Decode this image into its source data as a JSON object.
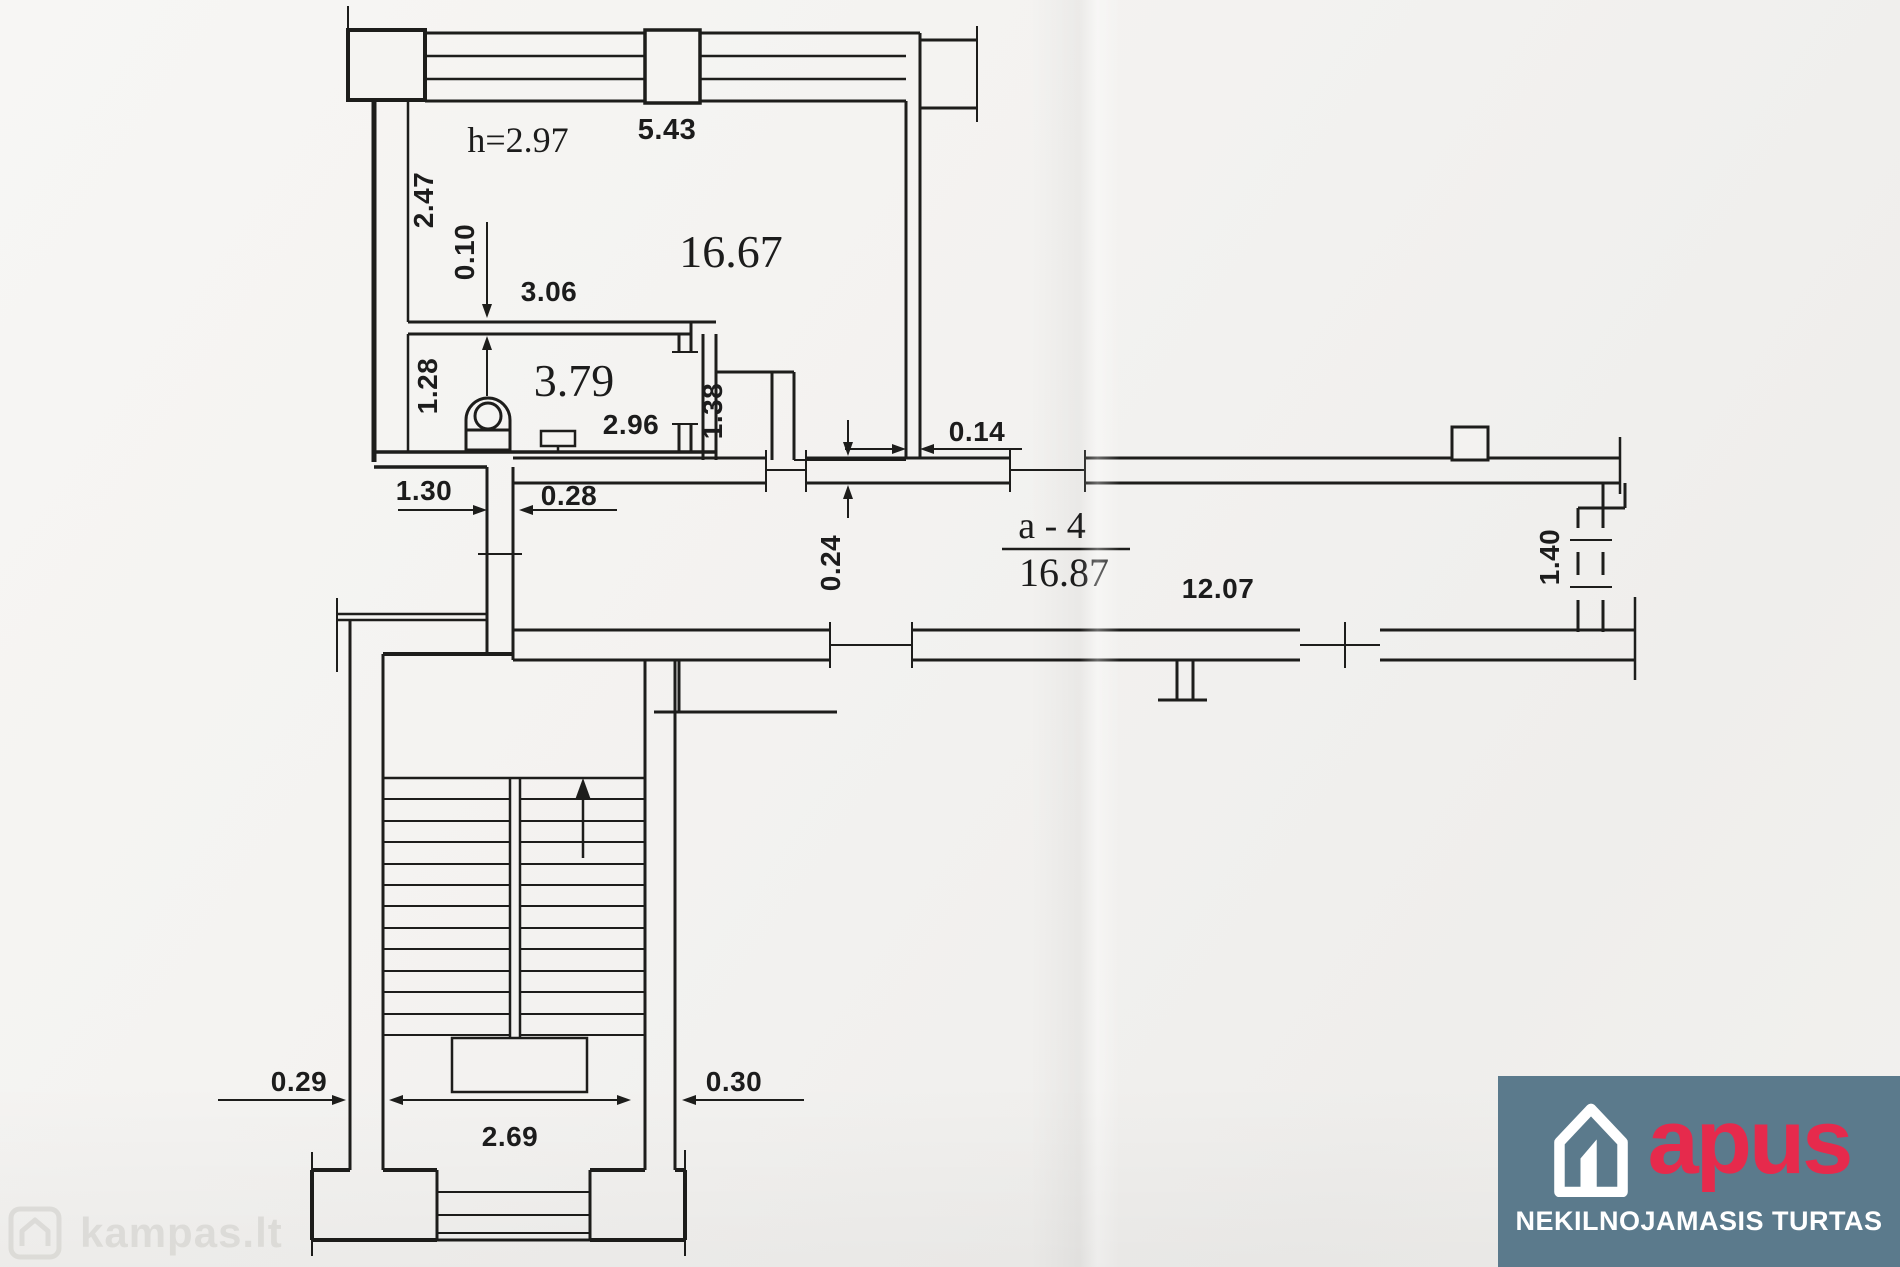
{
  "floorplan": {
    "rooms": {
      "main": {
        "area": "16.67",
        "height_note": "h=2.97"
      },
      "wc": {
        "area": "3.79"
      },
      "corridor": {
        "designation": "a - 4",
        "area": "16.87",
        "length": "12.07"
      }
    },
    "dims": {
      "window_top": "5.43",
      "room_left": "2.47",
      "partition_thickness": "0.10",
      "partition_length": "3.06",
      "wc_left": "1.28",
      "wc_width": "2.96",
      "niche_right": "1.38",
      "wall_thickness_right": "0.14",
      "door_left": "1.30",
      "door_wall": "0.28",
      "corridor_wall_thickness": "0.24",
      "corridor_end_door": "1.40",
      "stair_wall_left": "0.29",
      "stair_inner_width": "2.69",
      "stair_wall_right": "0.30"
    }
  },
  "watermark": {
    "text": "kampas.lt"
  },
  "logo": {
    "brand": "apus",
    "tagline": "NEKILNOJAMASIS TURTAS"
  },
  "colors": {
    "paper": "#f3f2f0",
    "line": "#1c1c1c",
    "logo_bg": "#5b7a8c",
    "logo_brand": "#e62a4c",
    "logo_text": "#ffffff",
    "watermark": "#dbdad6"
  }
}
